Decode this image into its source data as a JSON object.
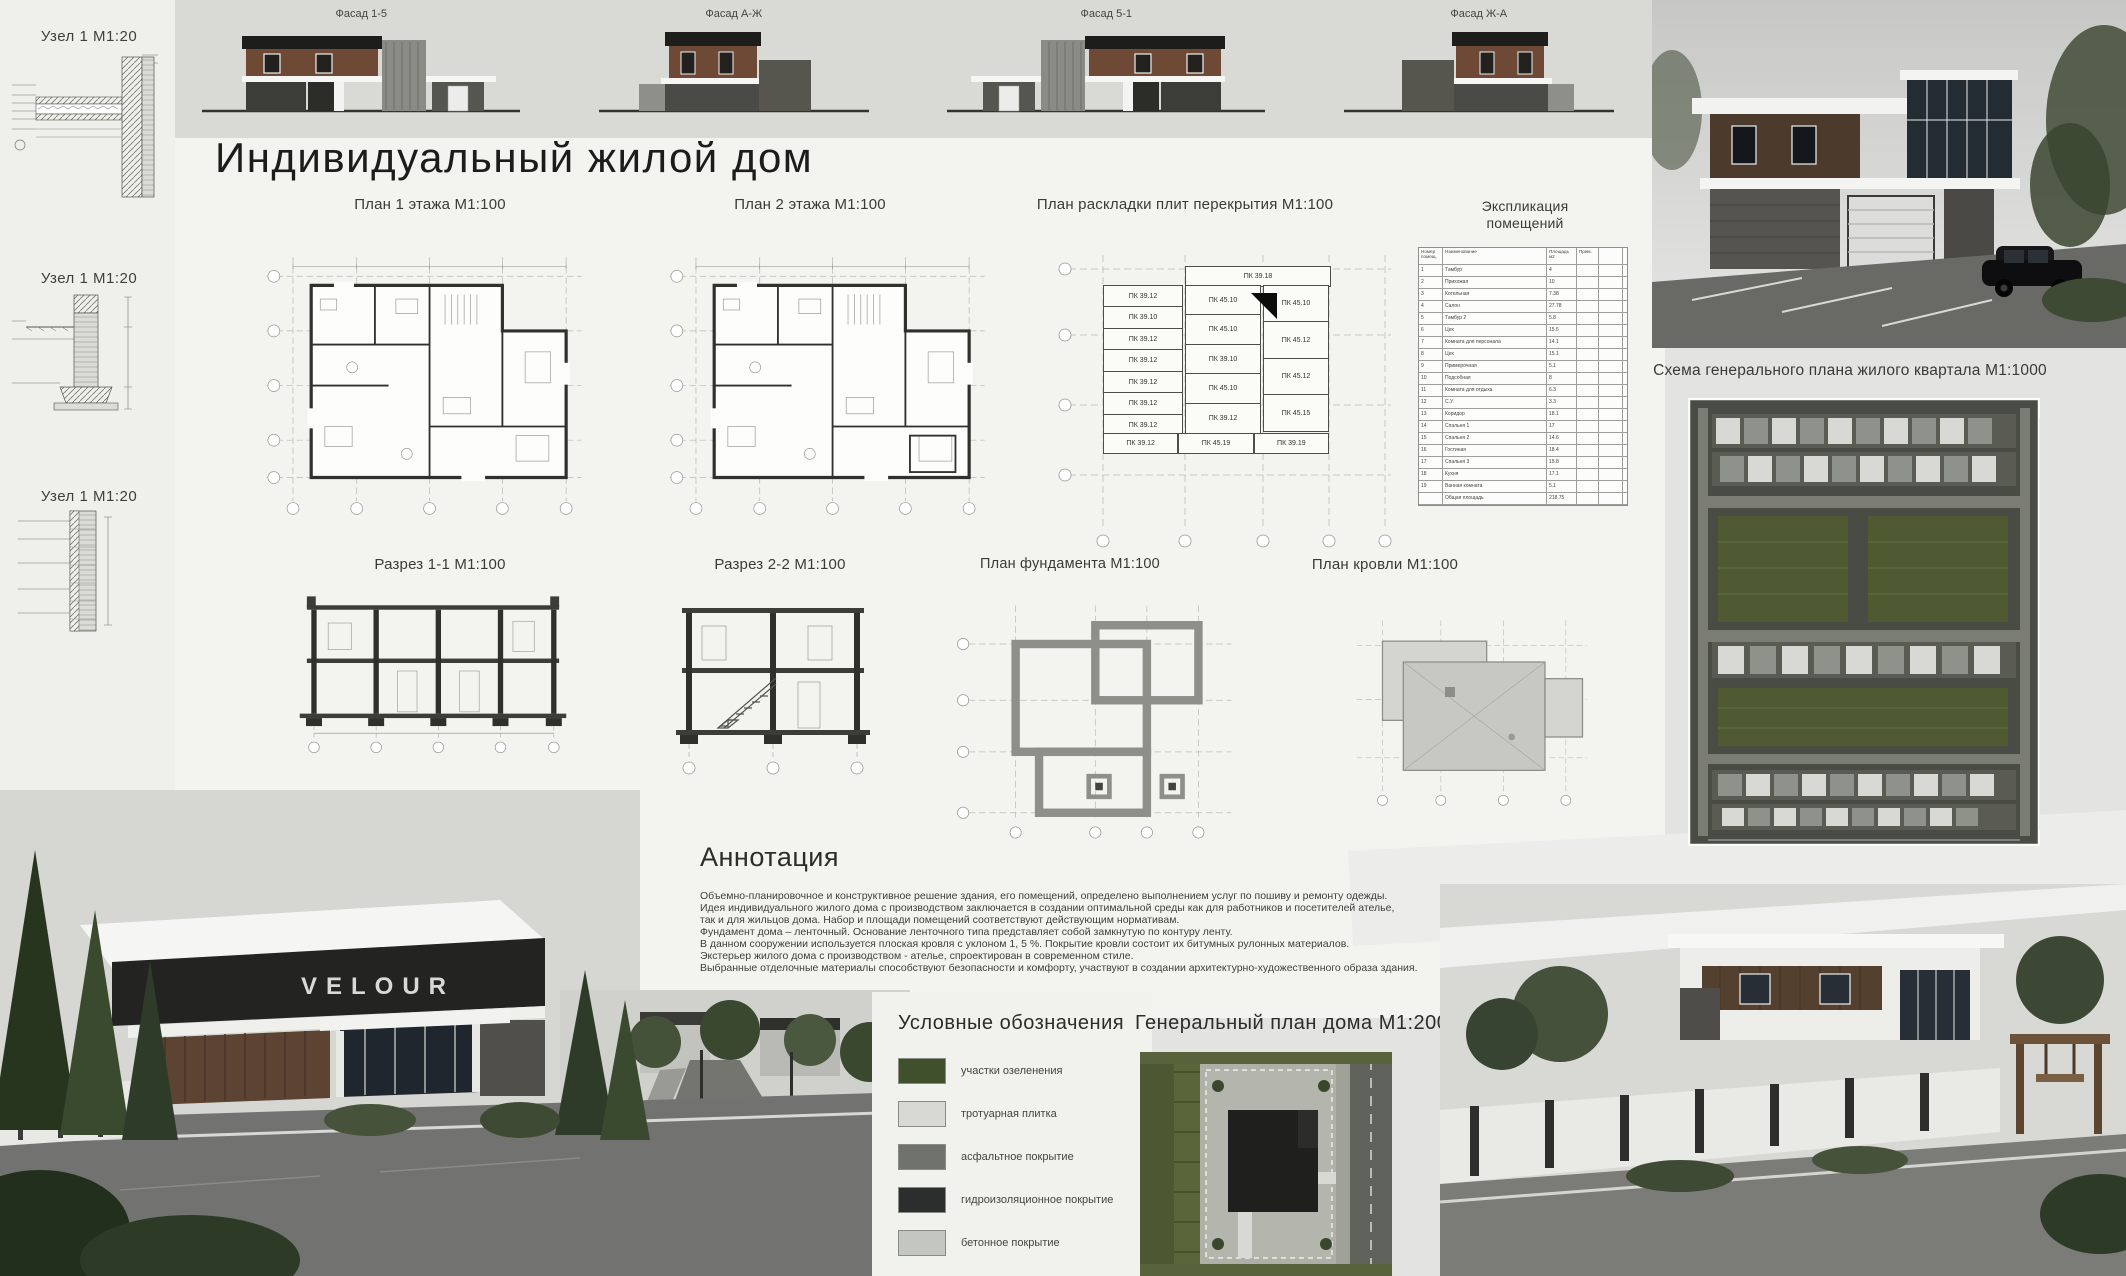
{
  "poster": {
    "title": "Индивидуальный жилой дом",
    "nodes": {
      "label": "Узел 1 М1:20"
    },
    "facades": {
      "labels": [
        "Фасад 1-5",
        "Фасад А-Ж",
        "Фасад 5-1",
        "Фасад Ж-А"
      ]
    },
    "sections": {
      "plan1": "План 1 этажа М1:100",
      "plan2": "План 2 этажа М1:100",
      "slabs": "План раскладки плит перекрытия М1:100",
      "explication_line1": "Экспликация",
      "explication_line2": "помещений",
      "section11": "Разрез 1-1 М1:100",
      "section22": "Разрез 2-2 М1:100",
      "foundation": "План фундамента М1:100",
      "roof": "План кровли М1:100",
      "masterplan": "Схема генерального плана жилого квартала М1:1000",
      "siteplan": "Генеральный план дома М1:200"
    },
    "slab_plan": {
      "top": "ПК 39.18",
      "col_a": [
        "ПК 39.12",
        "ПК 39.10",
        "ПК 39.12",
        "ПК 39.12",
        "ПК 39.12",
        "ПК 39.12",
        "ПК 39.12"
      ],
      "col_b": [
        "ПК 45.10",
        "ПК 45.10",
        "ПК 39.10",
        "ПК 45.10",
        "ПК 39.12"
      ],
      "col_c": [
        "ПК 45.10",
        "ПК 45.12",
        "ПК 45.12",
        "ПК 45.15"
      ],
      "bottom": [
        "ПК 39.12",
        "ПК 45.19",
        "ПК 39.19"
      ]
    },
    "explication": {
      "headers": [
        "Номер помещ.",
        "Наименование",
        "Площадь м2",
        "Прим."
      ],
      "rows": [
        [
          "1",
          "Тамбур",
          "4",
          ""
        ],
        [
          "2",
          "Прихожая",
          "10",
          ""
        ],
        [
          "3",
          "Котельная",
          "7.38",
          ""
        ],
        [
          "4",
          "Салон",
          "27.78",
          ""
        ],
        [
          "5",
          "Тамбур 2",
          "5.8",
          ""
        ],
        [
          "6",
          "Цех",
          "15.5",
          ""
        ],
        [
          "7",
          "Комната для персонала",
          "14.1",
          ""
        ],
        [
          "8",
          "Цех",
          "15.1",
          ""
        ],
        [
          "9",
          "Примерочная",
          "5.1",
          ""
        ],
        [
          "10",
          "Подсобная",
          "8",
          ""
        ],
        [
          "11",
          "Комната для отдыха",
          "6.3",
          ""
        ],
        [
          "12",
          "С.У.",
          "3.3",
          ""
        ],
        [
          "13",
          "Коридор",
          "18.1",
          ""
        ],
        [
          "14",
          "Спальня 1",
          "17",
          ""
        ],
        [
          "15",
          "Спальня 2",
          "14.6",
          ""
        ],
        [
          "16",
          "Гостиная",
          "18.4",
          ""
        ],
        [
          "17",
          "Спальня 3",
          "15.8",
          ""
        ],
        [
          "18",
          "Кухня",
          "17.1",
          ""
        ],
        [
          "19",
          "Ванная комната",
          "5.1",
          ""
        ],
        [
          "",
          "Общая площадь",
          "218.75",
          ""
        ]
      ]
    },
    "annotation": {
      "title": "Аннотация",
      "lines": [
        "Объемно-планировочное и конструктивное решение здания, его помещений, определено выполнением услуг по пошиву и ремонту одежды.",
        "Идея индивидуального жилого дома с производством заключается в создании оптимальной среды как для работников и посетителей ателье,",
        "так и для жильцов дома. Набор и площади помещений соответствуют действующим нормативам.",
        "Фундамент дома – ленточный. Основание ленточного типа представляет собой замкнутую по контуру ленту.",
        "В данном сооружении используется плоская кровля с уклоном 1, 5 %. Покрытие кровли состоит их  битумных рулонных материалов.",
        "Экстерьер жилого дома с производством - ателье, спроектирован в современном стиле.",
        "Выбранные отделочные материалы способствуют безопасности и комфорту, участвуют в создании архитектурно-художественного образа здания."
      ]
    },
    "legend": {
      "title": "Условные обозначения",
      "items": [
        {
          "label": "участки озеленения",
          "color": "#41502c"
        },
        {
          "label": "тротуарная плитка",
          "color": "#d8d8d4"
        },
        {
          "label": "асфальтное покрытие",
          "color": "#70726e"
        },
        {
          "label": "гидроизоляционное покрытие",
          "color": "#2b2e2d"
        },
        {
          "label": "бетонное покрытие",
          "color": "#c4c6c2"
        }
      ]
    },
    "render_sign": "VELOUR"
  }
}
